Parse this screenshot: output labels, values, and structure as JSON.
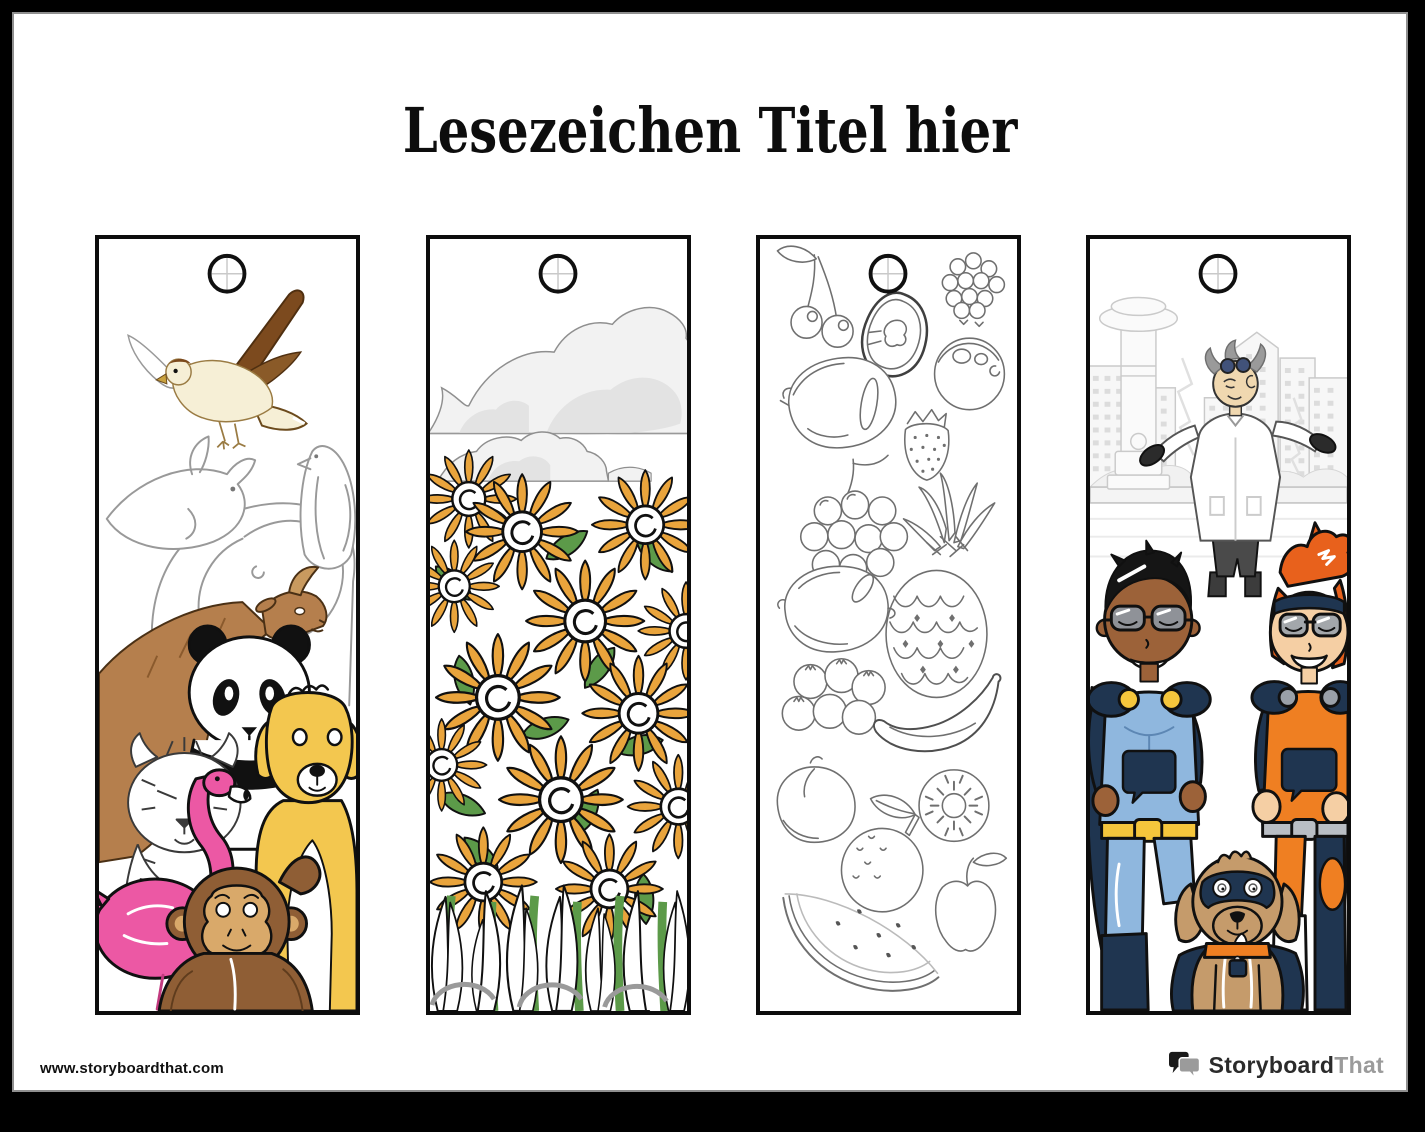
{
  "page": {
    "title": "Lesezeichen Titel hier",
    "footer_url": "www.storyboardthat.com",
    "brand": {
      "primary": "Storyboard",
      "secondary": "That",
      "logo_icon": "speech-bubbles-icon"
    }
  },
  "bookmarks": [
    {
      "id": "animals",
      "punch_hole": true,
      "depicts": [
        "hawk",
        "dolphin",
        "penguin",
        "elephant",
        "goat",
        "panda",
        "tiger",
        "flamingo",
        "golden-dog",
        "monkey"
      ]
    },
    {
      "id": "sunflowers",
      "punch_hole": true,
      "depicts": [
        "clouds",
        "sunflower-field",
        "leaves",
        "grass"
      ]
    },
    {
      "id": "fruits",
      "punch_hole": true,
      "depicts": [
        "cherries",
        "berry-cluster",
        "papaya",
        "coconut",
        "plum",
        "strawberry",
        "grapes",
        "pineapple",
        "lemon",
        "blueberries",
        "banana",
        "peach",
        "kiwi",
        "orange",
        "apple",
        "watermelon"
      ]
    },
    {
      "id": "superheroes",
      "punch_hole": true,
      "depicts": [
        "city-skyline",
        "fountain",
        "scientist",
        "superhero-boy",
        "superhero-girl",
        "superhero-dog"
      ]
    }
  ],
  "colors": {
    "hawk_brown": "#7C4A1E",
    "hawk_cream": "#F6EFD6",
    "goat_brown": "#B57F4D",
    "flamingo_pink": "#EC58A4",
    "dog_gold": "#F3C74F",
    "monkey_brown": "#8F5E35",
    "monkey_face": "#D9A96A",
    "sunflower_orange": "#E9A43C",
    "leaf_green": "#5C9A49",
    "hero_navy": "#1F3550",
    "hero_blue": "#8FB7DE",
    "hero_orange": "#EF7F22",
    "hero_yellow": "#F5C63C",
    "hero_hair_orange": "#E8611C",
    "skin_light": "#F5CFA4",
    "skin_dark": "#9C6239",
    "scientist_skin": "#F0D8B0",
    "dog_tan": "#C59B6B",
    "logo_black": "#1a1a1a",
    "logo_gray": "#9b9b9b"
  }
}
